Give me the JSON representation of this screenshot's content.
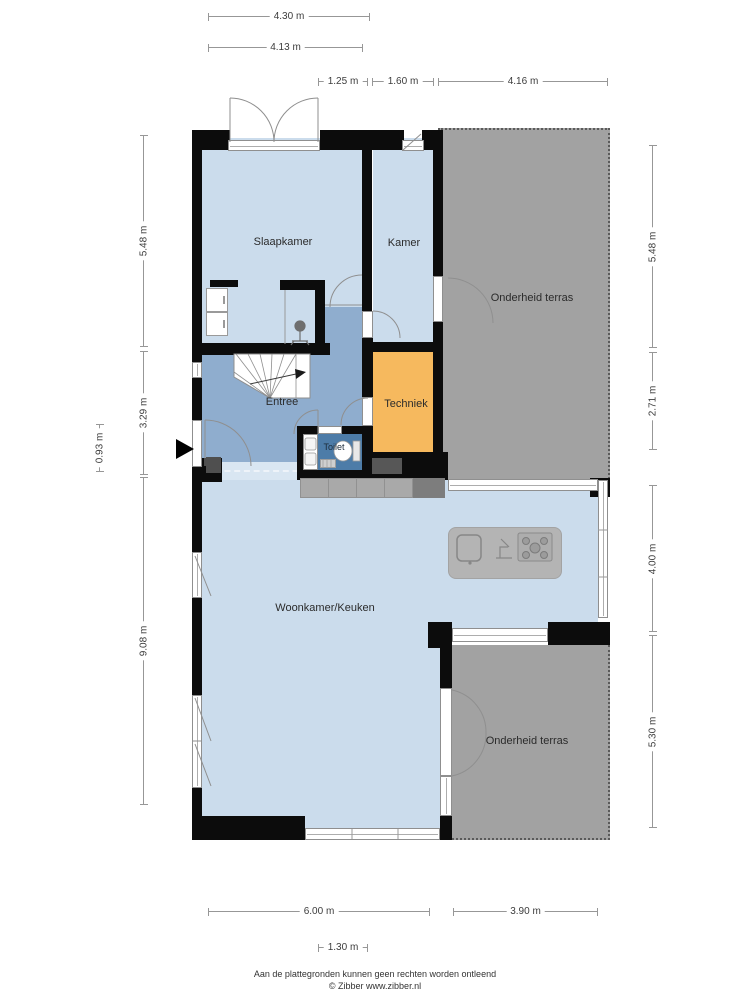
{
  "rooms": {
    "slaapkamer": "Slaapkamer",
    "kamer": "Kamer",
    "terras_top": "Onderheid terras",
    "entree": "Entree",
    "techniek": "Techniek",
    "toilet": "Toilet",
    "woonkamer": "Woonkamer/Keuken",
    "terras_bottom": "Onderheid terras"
  },
  "dims": {
    "top": [
      "4.30 m",
      "4.13 m",
      "1.25 m",
      "1.60 m",
      "4.16 m"
    ],
    "left": [
      "5.48 m",
      "3.29 m",
      "0.93 m",
      "9.08 m"
    ],
    "right": [
      "5.48 m",
      "2.71 m",
      "4.00 m",
      "5.30 m"
    ],
    "bottom": [
      "6.00 m",
      "3.90 m",
      "1.30 m"
    ]
  },
  "footer": {
    "line1": "Aan de plattegronden kunnen geen rechten worden ontleend",
    "line2": "© Zibber www.zibber.nl"
  },
  "palette": {
    "room_fill": "#cbdcec",
    "hall_fill": "#8fadce",
    "toilet_fill": "#4d7ca8",
    "techniek_fill": "#f6b95e",
    "terrace_fill": "#a2a2a2",
    "wall": "#0c0c0c",
    "counter_gray": "#a9a9a9",
    "dark_gray": "#555555",
    "window_line": "#8f8f8f",
    "dimension_line": "#979797"
  },
  "icons": {
    "entrance-arrow-icon": "black triangle pointing right at front door",
    "stairs-icon": "winder staircase with direction arrow",
    "shower-icon": "shower head",
    "toilet-icon": "toilet bowl with cistern",
    "washbasin-icon": "small washbasin pair",
    "wardrobe-icon": "built-in wardrobe",
    "sink-icon": "island sink basin",
    "faucet-icon": "kitchen tap",
    "cooktop-icon": "5-burner hob"
  }
}
